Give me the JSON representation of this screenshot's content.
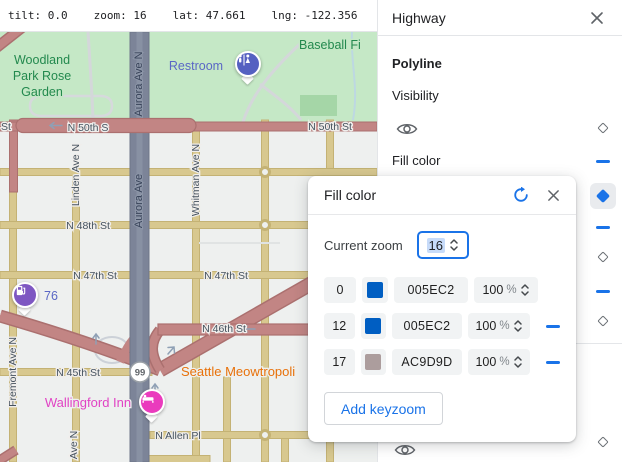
{
  "topbar": {
    "tilt": "tilt: 0.0",
    "zoom": "zoom: 16",
    "lat": "lat: 47.661",
    "lng": "lng: -122.356"
  },
  "map": {
    "labels": {
      "st_partial": "St",
      "n50_left": "N 50th S",
      "n50_right": "N 50th St",
      "n48": "N 48th St",
      "n47_left": "N 47th St",
      "n47_right": "N 47th St",
      "n46": "N 46th St",
      "n45": "N 45th St",
      "allen": "N Allen Pl",
      "aurora_top": "Aurora Ave N",
      "aurora_mid": "Aurora Ave",
      "linden": "Linden Ave N",
      "whitman": "Whitman Ave N",
      "fremont": "Fremont Ave N",
      "ave_n": "Ave N",
      "park_line1": "Woodland",
      "park_line2": "Park Rose",
      "park_line3": "Garden",
      "baseball": "Baseball Fi",
      "restroom": "Restroom",
      "gas": "76",
      "cafe": "Seattle Meowtropoli",
      "hotel": "Wallingford Inn",
      "route_shield": "99"
    },
    "colors": {
      "background": "#eef0ef",
      "park": "#c5e8c6",
      "park_field": "#a5d6a7",
      "road_highway": "#c28584",
      "road_arterial": "#d8c88f",
      "road_aurora": "#7c8498",
      "restroom_pin": "#5560c1",
      "gas_pin": "#7e57c2",
      "hotel_pin": "#ea3bbd",
      "poi_blue_label": "#5a67c5",
      "cafe_label": "#e8710a",
      "hotel_label": "#e143c4"
    }
  },
  "panel": {
    "title": "Highway",
    "section_label": "Polyline",
    "visibility_label": "Visibility",
    "fill_color_label": "Fill color",
    "accent_color": "#1a73e8"
  },
  "dialog": {
    "title": "Fill color",
    "current_zoom_label": "Current zoom",
    "current_zoom_value": "16",
    "rows": [
      {
        "zoom": "0",
        "hex": "005EC2",
        "opacity": "100",
        "unit": "%"
      },
      {
        "zoom": "12",
        "hex": "005EC2",
        "opacity": "100",
        "unit": "%"
      },
      {
        "zoom": "17",
        "hex": "AC9D9D",
        "opacity": "100",
        "unit": "%"
      }
    ],
    "add_button_label": "Add keyzoom"
  }
}
